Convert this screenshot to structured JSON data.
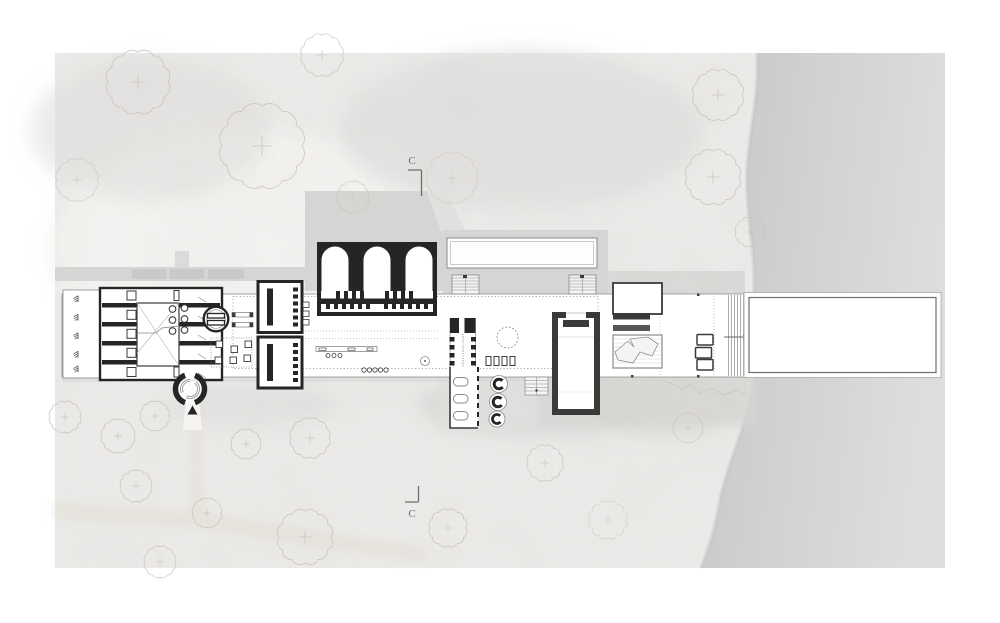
{
  "drawing": {
    "section_markers": {
      "top": {
        "label": "C"
      },
      "bottom": {
        "label": "C"
      }
    }
  },
  "palette": {
    "page_bg": "#ffffff",
    "land": "#edecea",
    "land_wash_dark": "#e1e0de",
    "land_wash_light": "#f5f4f2",
    "shadow": "#d6d5d3",
    "shadow_deep": "#c9c7c5",
    "water_edge": "#c3c5c8",
    "water_mid": "#cfd1d2",
    "water_far": "#dcdddd",
    "ink": "#262523",
    "wall": "#3b3a38",
    "line": "#8a8988",
    "line_light": "#b5b4b2",
    "tree": "#c6c2b9",
    "path": "#e6e2db",
    "label": "#6f6e6c"
  },
  "trees": [
    {
      "x": 138,
      "y": 82,
      "r": 30,
      "o": 0.9
    },
    {
      "x": 262,
      "y": 146,
      "r": 40,
      "o": 0.9
    },
    {
      "x": 322,
      "y": 55,
      "r": 20,
      "o": 0.8
    },
    {
      "x": 77,
      "y": 180,
      "r": 20,
      "o": 0.7
    },
    {
      "x": 353,
      "y": 197,
      "r": 15,
      "o": 0.7
    },
    {
      "x": 452,
      "y": 178,
      "r": 24,
      "o": 0.55
    },
    {
      "x": 718,
      "y": 95,
      "r": 24,
      "o": 0.9
    },
    {
      "x": 713,
      "y": 177,
      "r": 26,
      "o": 0.9
    },
    {
      "x": 750,
      "y": 232,
      "r": 14,
      "o": 0.8
    },
    {
      "x": 65,
      "y": 417,
      "r": 15,
      "o": 0.9
    },
    {
      "x": 118,
      "y": 436,
      "r": 16,
      "o": 0.9
    },
    {
      "x": 155,
      "y": 416,
      "r": 14,
      "o": 0.9
    },
    {
      "x": 136,
      "y": 486,
      "r": 15,
      "o": 0.9
    },
    {
      "x": 207,
      "y": 513,
      "r": 14,
      "o": 0.85
    },
    {
      "x": 246,
      "y": 444,
      "r": 14,
      "o": 0.85
    },
    {
      "x": 310,
      "y": 438,
      "r": 19,
      "o": 0.9
    },
    {
      "x": 305,
      "y": 537,
      "r": 26,
      "o": 0.9
    },
    {
      "x": 160,
      "y": 562,
      "r": 15,
      "o": 0.8
    },
    {
      "x": 448,
      "y": 528,
      "r": 18,
      "o": 0.85
    },
    {
      "x": 545,
      "y": 463,
      "r": 17,
      "o": 0.8
    },
    {
      "x": 608,
      "y": 520,
      "r": 18,
      "o": 0.6
    },
    {
      "x": 688,
      "y": 428,
      "r": 14,
      "o": 0.7
    }
  ]
}
